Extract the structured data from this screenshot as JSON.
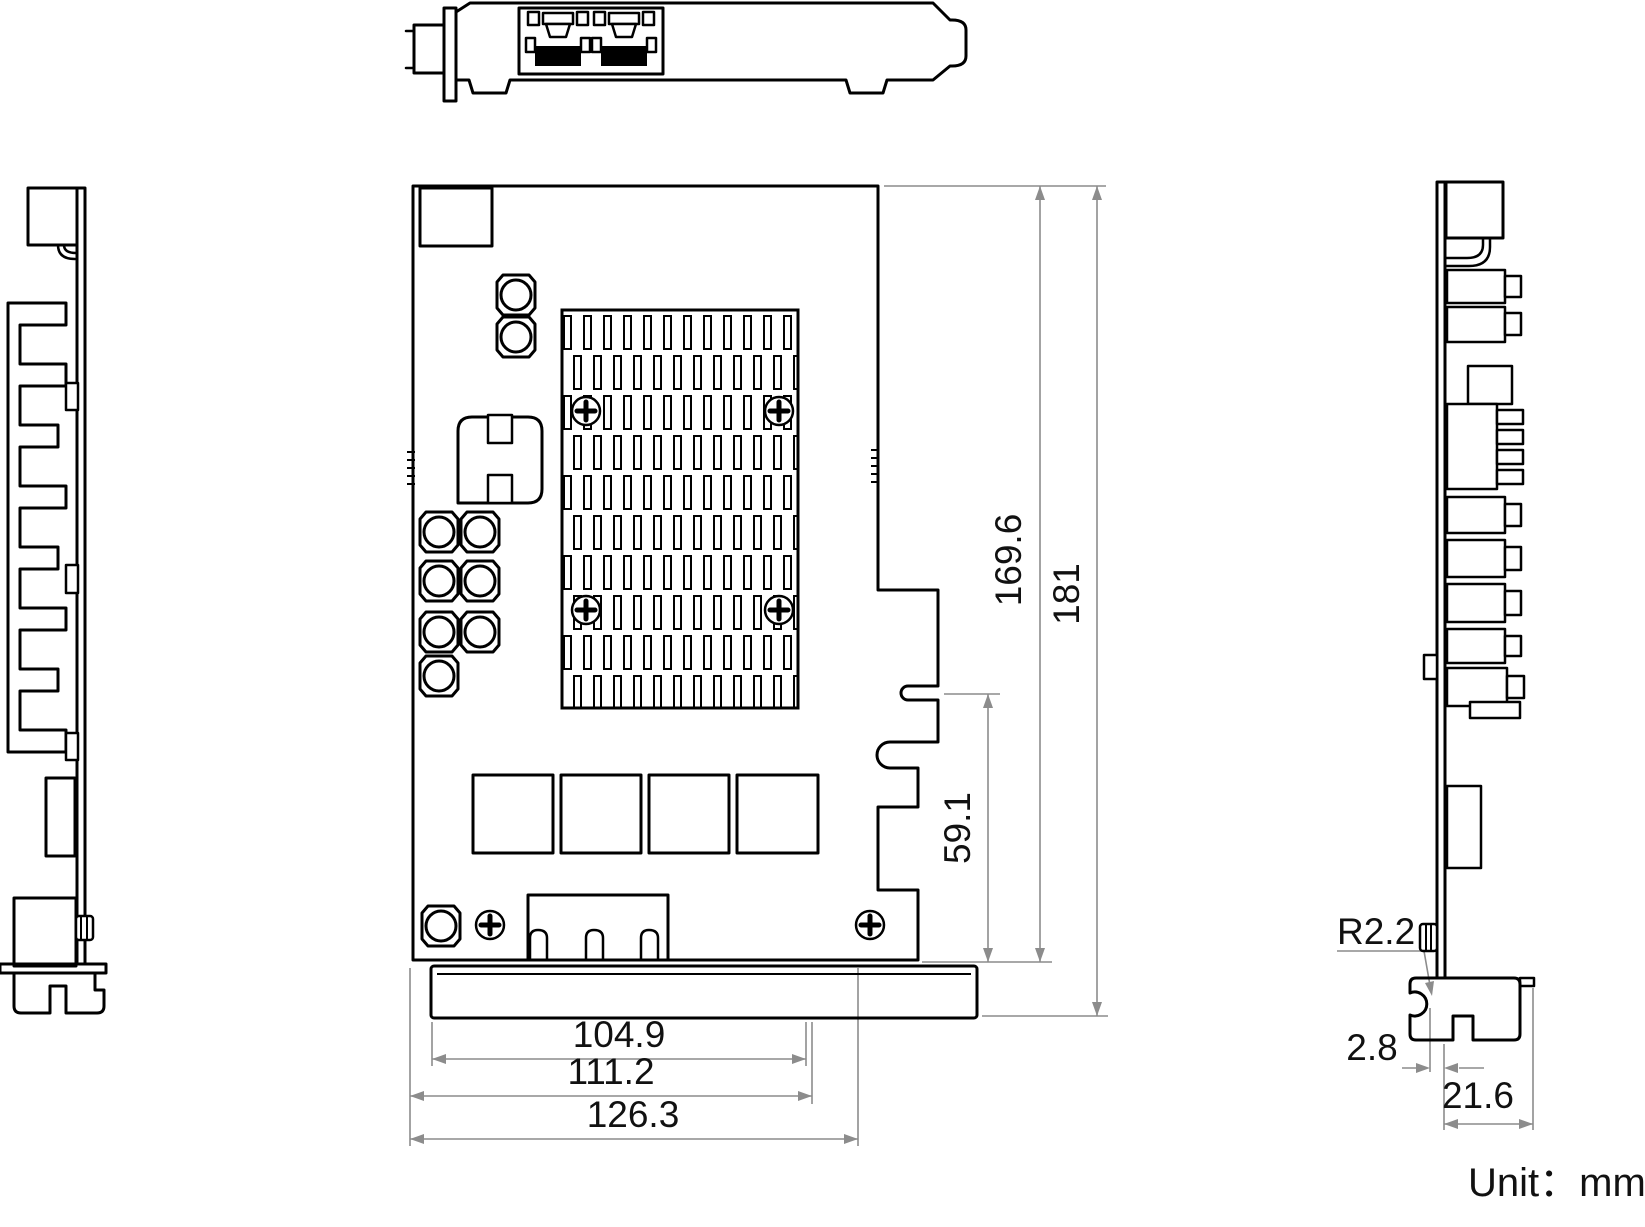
{
  "drawing": {
    "unit_label": "Unit：mm",
    "dimensions": {
      "pcb_height": "169.6",
      "total_height": "181",
      "edge_notch_height": "59.1",
      "goldfinger_width": "104.9",
      "pcb_lower_width": "111.2",
      "pcb_total_width": "126.3",
      "bracket_corner_radius": "R2.2",
      "bracket_notch_offset": "2.8",
      "bracket_foot_width": "21.6"
    },
    "colors": {
      "outline": "#000000",
      "dimension_line": "#8c8c8c",
      "text": "#111111",
      "background": "#ffffff"
    }
  }
}
